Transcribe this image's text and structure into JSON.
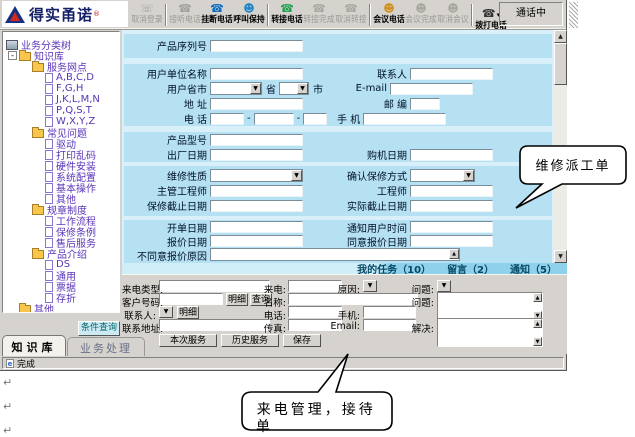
{
  "app": {
    "logo": "得实甬诺",
    "reg": "®",
    "call_status": "通话中"
  },
  "toolbar": {
    "buttons": [
      {
        "label": "取消登录",
        "enabled": false,
        "icon": "cancel-login-icon"
      },
      {
        "label": "接听电话",
        "enabled": false,
        "icon": "answer-call-icon"
      },
      {
        "label": "挂断电话",
        "enabled": true,
        "icon": "hangup-call-icon"
      },
      {
        "label": "呼叫保持",
        "enabled": true,
        "icon": "hold-call-icon"
      },
      {
        "label": "转接电话",
        "enabled": true,
        "icon": "transfer-call-icon"
      },
      {
        "label": "转接完成",
        "enabled": false,
        "icon": "transfer-done-icon"
      },
      {
        "label": "取消转接",
        "enabled": false,
        "icon": "cancel-transfer-icon"
      },
      {
        "label": "会议电话",
        "enabled": true,
        "icon": "conference-call-icon"
      },
      {
        "label": "会议完成",
        "enabled": false,
        "icon": "conference-done-icon"
      },
      {
        "label": "取消会议",
        "enabled": false,
        "icon": "cancel-conference-icon"
      },
      {
        "label": "拨打电话",
        "enabled": true,
        "icon": "dial-call-icon"
      }
    ]
  },
  "tree": {
    "rows": [
      {
        "label": "业务分类树"
      },
      {
        "label": "知识库"
      },
      {
        "label": "服务网点"
      },
      {
        "label": "A,B,C,D"
      },
      {
        "label": "F,G,H"
      },
      {
        "label": "J,K,L,M,N"
      },
      {
        "label": "P,Q,S,T"
      },
      {
        "label": "W,X,Y,Z"
      },
      {
        "label": "常见问题"
      },
      {
        "label": "驱动"
      },
      {
        "label": "打印乱码"
      },
      {
        "label": "硬件安装"
      },
      {
        "label": "系统配置"
      },
      {
        "label": "基本操作"
      },
      {
        "label": "其他"
      },
      {
        "label": "规章制度"
      },
      {
        "label": "工作流程"
      },
      {
        "label": "保修条例"
      },
      {
        "label": "售后服务"
      },
      {
        "label": "产品介绍"
      },
      {
        "label": "DS"
      },
      {
        "label": "通用"
      },
      {
        "label": "票据"
      },
      {
        "label": "存折"
      },
      {
        "label": "其他"
      }
    ],
    "query_button": "条件查询"
  },
  "form": {
    "serial": "产品序列号",
    "unit_name": "用户单位名称",
    "contact": "联系人",
    "user_region": "用户省市",
    "province_suffix": "省",
    "city_suffix": "市",
    "email": "E-mail",
    "address": "地 址",
    "postcode": "邮 编",
    "phone": "电 话",
    "dash": "-",
    "mobile": "手 机",
    "model": "产品型号",
    "ship_date": "出厂日期",
    "purchase_date": "购机日期",
    "repair_type": "维修性质",
    "warranty_confirm": "确认保修方式",
    "chief_engineer": "主管工程师",
    "engineer": "工程师",
    "warranty_deadline": "保修截止日期",
    "actual_deadline": "实际截止日期",
    "open_date": "开单日期",
    "notify_user_time": "通知用户时间",
    "quote_date": "报价日期",
    "agree_quote_date": "同意报价日期",
    "reject_reason": "不同意报价原因"
  },
  "task_tabs": [
    {
      "label": "我的任务（10）"
    },
    {
      "label": "留言（2）"
    },
    {
      "label": "通知（5）"
    }
  ],
  "call_panel": {
    "call_type": "来电类型:",
    "incoming": "来电:",
    "reason": "原因:",
    "question": "问题:",
    "customer_no": "客户号码:",
    "detail_btn": "明细",
    "query_btn": "查询",
    "name": "名称:",
    "question2": "问题:",
    "contact": "联系人:",
    "detail2_btn": "明细",
    "tel": "电话:",
    "mobile": "手机:",
    "address": "联系地址:",
    "fax": "传真:",
    "email_lbl": "Email:",
    "solve": "解决:",
    "buttons": [
      "本次服务",
      "历史服务",
      "保存"
    ]
  },
  "left_tabs": {
    "knowledge": "知识库",
    "business": "业务处理"
  },
  "statusbar": {
    "text": "完成"
  },
  "callouts": {
    "repair": "维修派工单",
    "incoming_line1": "来电管理，接待",
    "incoming_line2": "单"
  }
}
